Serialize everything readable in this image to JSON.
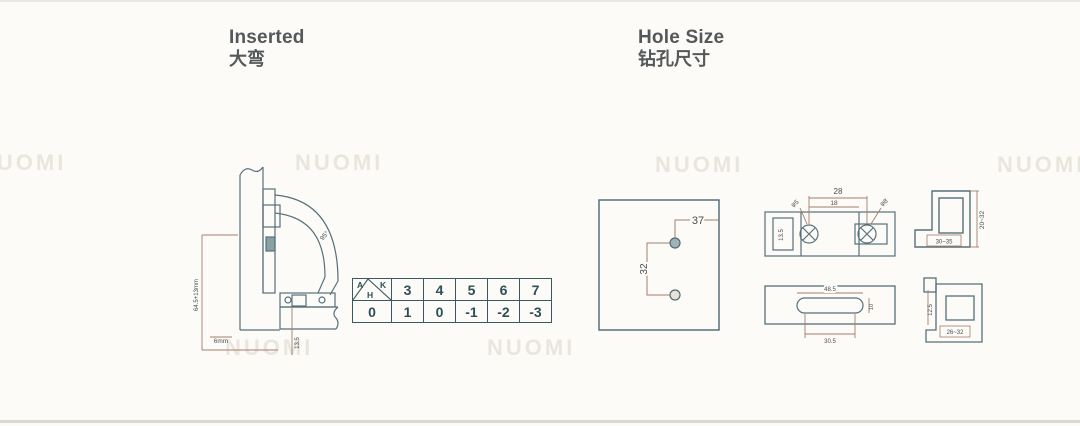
{
  "titles": {
    "left_en": "Inserted",
    "left_zh": "大弯",
    "right_en": "Hole Size",
    "right_zh": "钻孔尺寸"
  },
  "watermark": {
    "text": "NUOMI"
  },
  "adjust_table": {
    "corner_a": "A",
    "corner_k": "K",
    "corner_h": "H",
    "header": [
      "3",
      "4",
      "5",
      "6",
      "7"
    ],
    "row_label": "0",
    "values": [
      "1",
      "0",
      "-1",
      "-2",
      "-3"
    ]
  },
  "hinge_drawing": {
    "left_dim": "64.5+13mm",
    "angle": "95°",
    "bottom_dim": "6mm",
    "depth_dim": "13.5"
  },
  "hole_panel": {
    "dim_edge": "37",
    "dim_spacing": "32"
  },
  "plate_front": {
    "dim_width": "28",
    "dim_inner": "18",
    "hole_left": "φ5",
    "hole_right": "φ8",
    "dim_side": "13.5"
  },
  "profile_top": {
    "dim_height": "20~32",
    "dim_depth": "30~35"
  },
  "slot_plate": {
    "dim_outer": "48.5",
    "dim_inner": "30.5",
    "dim_height": "10"
  },
  "profile_bottom": {
    "dim_side": "12.5",
    "dim_depth": "26~32"
  },
  "colors": {
    "outline": "#56707a",
    "dimension": "#a57d6a"
  }
}
